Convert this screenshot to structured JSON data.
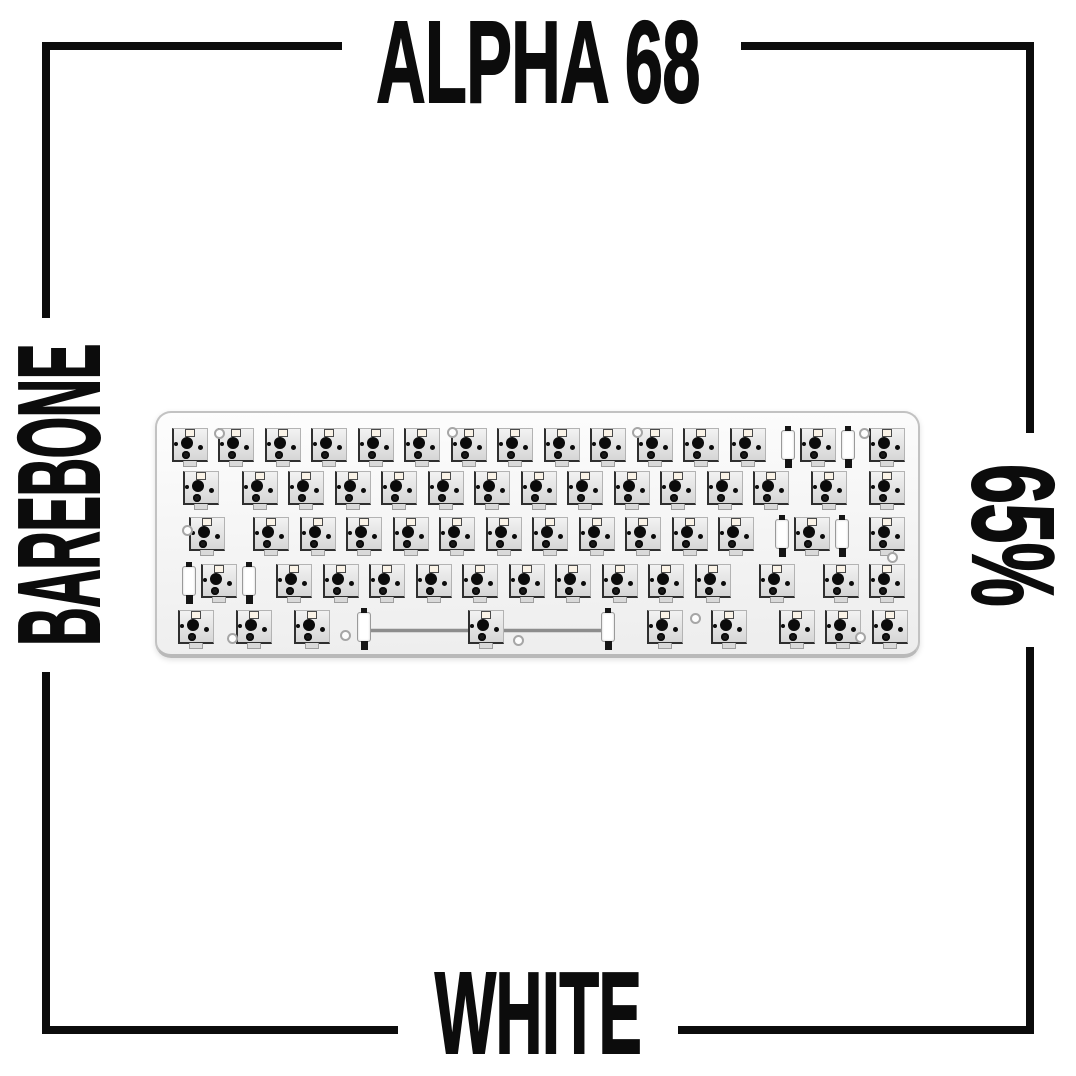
{
  "poster": {
    "title": "ALPHA 68",
    "left_label": "BAREBONE",
    "right_label": "65%",
    "bottom_label": "WHITE"
  },
  "colors": {
    "background": "#ffffff",
    "ink": "#0c0c0c",
    "plate_fill": "#f4f4f4",
    "plate_border": "#c2c2c2",
    "socket_fill": "#e0e0e0",
    "socket_outline": "#2f2f2f",
    "dot": "#0b0b0b",
    "led_window": "#faf3e7",
    "stab_clip": "#ffffff",
    "stab_wire": "#8d8d8d",
    "screw_ring": "#a6a6a6"
  },
  "keyboard": {
    "description": "65% barebone hot-swap keyboard plate without keycaps, 67 switch sockets, stabilizer hardware on wide keys",
    "unit_px": 46.5,
    "margin_px": 9.5,
    "row_center_y": [
      32,
      75,
      121,
      168,
      214
    ],
    "rows": [
      [
        {
          "u": 1
        },
        {
          "u": 1
        },
        {
          "u": 1
        },
        {
          "u": 1
        },
        {
          "u": 1
        },
        {
          "u": 1
        },
        {
          "u": 1
        },
        {
          "u": 1
        },
        {
          "u": 1
        },
        {
          "u": 1
        },
        {
          "u": 1
        },
        {
          "u": 1
        },
        {
          "u": 1
        },
        {
          "u": 2,
          "stab": 30
        },
        {
          "u": 1
        }
      ],
      [
        {
          "u": 1.5
        },
        {
          "u": 1
        },
        {
          "u": 1
        },
        {
          "u": 1
        },
        {
          "u": 1
        },
        {
          "u": 1
        },
        {
          "u": 1
        },
        {
          "u": 1
        },
        {
          "u": 1
        },
        {
          "u": 1
        },
        {
          "u": 1
        },
        {
          "u": 1
        },
        {
          "u": 1
        },
        {
          "u": 1.5
        },
        {
          "u": 1
        }
      ],
      [
        {
          "u": 1.75
        },
        {
          "u": 1
        },
        {
          "u": 1
        },
        {
          "u": 1
        },
        {
          "u": 1
        },
        {
          "u": 1
        },
        {
          "u": 1
        },
        {
          "u": 1
        },
        {
          "u": 1
        },
        {
          "u": 1
        },
        {
          "u": 1
        },
        {
          "u": 1
        },
        {
          "u": 2.25,
          "stab": 30
        },
        {
          "u": 1
        }
      ],
      [
        {
          "u": 2.25,
          "stab": 30
        },
        {
          "u": 1
        },
        {
          "u": 1
        },
        {
          "u": 1
        },
        {
          "u": 1
        },
        {
          "u": 1
        },
        {
          "u": 1
        },
        {
          "u": 1
        },
        {
          "u": 1
        },
        {
          "u": 1
        },
        {
          "u": 1
        },
        {
          "u": 1.75
        },
        {
          "u": 1
        },
        {
          "u": 1
        }
      ],
      [
        {
          "u": 1.25
        },
        {
          "u": 1.25
        },
        {
          "u": 1.25
        },
        {
          "u": 6.25,
          "stab": 122,
          "wire": true
        },
        {
          "u": 1,
          "pre": 10
        },
        {
          "u": 1,
          "pre": 18
        },
        {
          "u": 1,
          "pre": 21
        },
        {
          "u": 1
        },
        {
          "u": 1
        }
      ]
    ],
    "screw_holes": [
      [
        62,
        20
      ],
      [
        295,
        19
      ],
      [
        480,
        19
      ],
      [
        707,
        20
      ],
      [
        30,
        117
      ],
      [
        735,
        144
      ],
      [
        75,
        225
      ],
      [
        188,
        222
      ],
      [
        361,
        227
      ],
      [
        538,
        205
      ],
      [
        703,
        224
      ]
    ]
  }
}
